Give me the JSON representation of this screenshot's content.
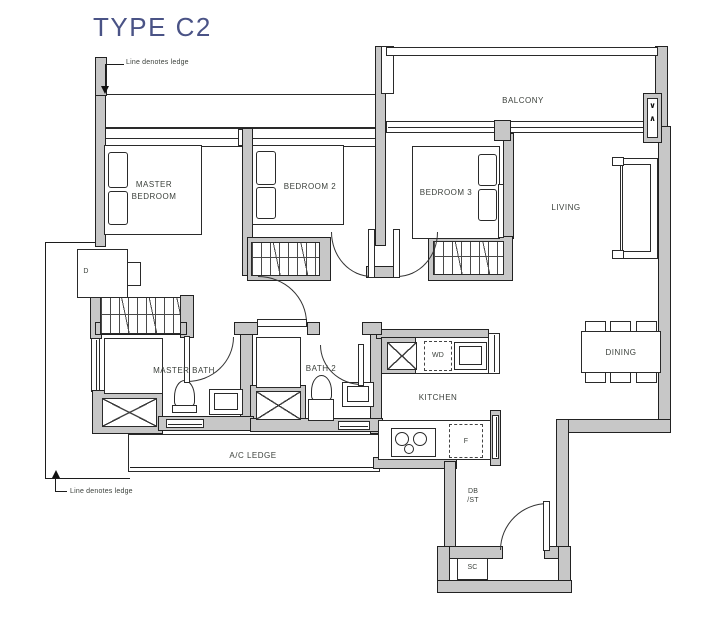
{
  "title": "TYPE C2",
  "annotations": {
    "top": "Line denotes ledge",
    "bottom": "Line denotes ledge"
  },
  "rooms": {
    "master_bedroom": "MASTER BEDROOM",
    "bedroom2": "BEDROOM 2",
    "bedroom3": "BEDROOM 3",
    "living": "LIVING",
    "balcony": "BALCONY",
    "dining": "DINING",
    "kitchen": "KITCHEN",
    "master_bath": "MASTER BATH",
    "bath2": "BATH 2",
    "ac_ledge": "A/C LEDGE"
  },
  "fixtures": {
    "washer_dryer": "WD",
    "fridge": "F",
    "dresser": "D",
    "db": "DB",
    "st": "/ST",
    "shoe_cabinet": "SC",
    "vent_top": "∨",
    "vent_bottom": "∧"
  },
  "colors": {
    "title": "#4a5386",
    "wall": "#c7c7c7",
    "line": "#1c1c1c",
    "label": "#3b403b"
  }
}
